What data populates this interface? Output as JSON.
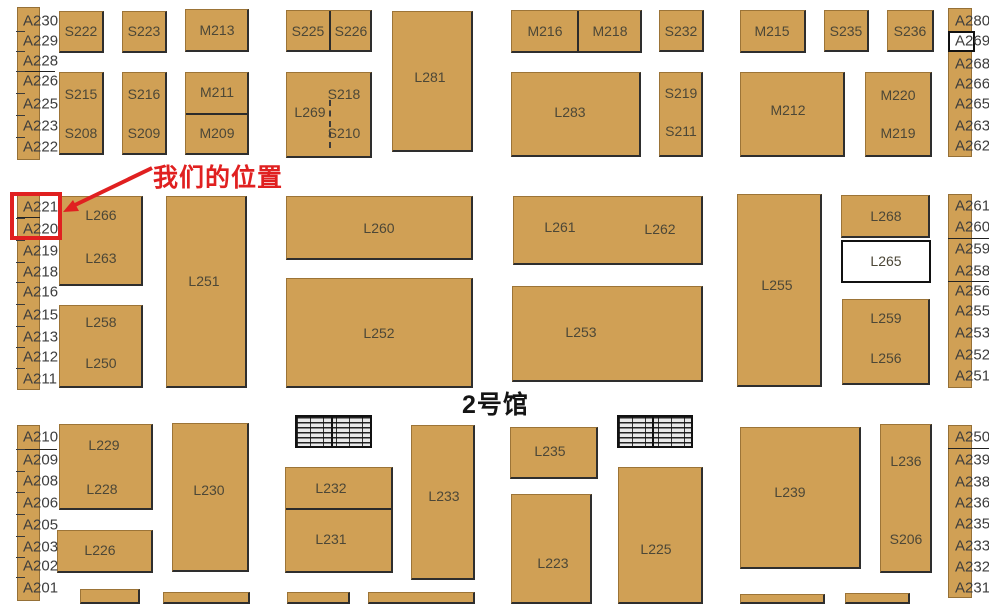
{
  "hall": {
    "title": "2号馆"
  },
  "annotation": {
    "label": "我们的位置",
    "color": "#e02020",
    "text_x": 153,
    "text_y": 158,
    "arrow": {
      "x1": 152,
      "y1": 168,
      "x2": 75,
      "y2": 205,
      "tip": [
        63,
        212
      ],
      "head": [
        [
          63,
          212
        ],
        [
          79,
          211
        ],
        [
          73,
          200
        ]
      ]
    },
    "highlight_box": {
      "x": 10,
      "y": 192,
      "w": 52,
      "h": 48,
      "booths": [
        "A221",
        "A220"
      ]
    }
  },
  "colors": {
    "booth_fill": "#d0a055",
    "booth_text": "#4c4737",
    "strip_text": "#3d3d3d",
    "white_fill": "#ffffff",
    "accent_red": "#e02020"
  },
  "booths": [
    {
      "id": "S222",
      "x": 59,
      "y": 11,
      "w": 45,
      "h": 42,
      "labels": [
        {
          "t": "S222",
          "x": 81,
          "y": 31
        }
      ]
    },
    {
      "id": "S223",
      "x": 122,
      "y": 11,
      "w": 45,
      "h": 42,
      "labels": [
        {
          "t": "S223",
          "x": 144,
          "y": 31
        }
      ]
    },
    {
      "id": "M213",
      "x": 185,
      "y": 9,
      "w": 64,
      "h": 43,
      "labels": [
        {
          "t": "M213",
          "x": 217,
          "y": 30
        }
      ]
    },
    {
      "id": "S225-S226",
      "x": 286,
      "y": 10,
      "w": 86,
      "h": 42,
      "dividers": [
        {
          "o": "v",
          "at": 329
        }
      ],
      "labels": [
        {
          "t": "S225",
          "x": 308,
          "y": 31
        },
        {
          "t": "S226",
          "x": 351,
          "y": 31
        }
      ]
    },
    {
      "id": "L281",
      "x": 392,
      "y": 11,
      "w": 81,
      "h": 141,
      "labels": [
        {
          "t": "L281",
          "x": 430,
          "y": 77
        }
      ]
    },
    {
      "id": "M216-M218",
      "x": 511,
      "y": 10,
      "w": 131,
      "h": 43,
      "dividers": [
        {
          "o": "v",
          "at": 577
        }
      ],
      "labels": [
        {
          "t": "M216",
          "x": 545,
          "y": 31
        },
        {
          "t": "M218",
          "x": 610,
          "y": 31
        }
      ]
    },
    {
      "id": "S232",
      "x": 659,
      "y": 10,
      "w": 45,
      "h": 42,
      "labels": [
        {
          "t": "S232",
          "x": 681,
          "y": 31
        }
      ]
    },
    {
      "id": "M215",
      "x": 740,
      "y": 10,
      "w": 66,
      "h": 43,
      "labels": [
        {
          "t": "M215",
          "x": 772,
          "y": 31
        }
      ]
    },
    {
      "id": "S235",
      "x": 824,
      "y": 10,
      "w": 45,
      "h": 42,
      "labels": [
        {
          "t": "S235",
          "x": 846,
          "y": 31
        }
      ]
    },
    {
      "id": "S236",
      "x": 887,
      "y": 10,
      "w": 47,
      "h": 42,
      "labels": [
        {
          "t": "S236",
          "x": 910,
          "y": 31
        }
      ]
    },
    {
      "id": "S215-S208",
      "x": 59,
      "y": 72,
      "w": 45,
      "h": 83,
      "labels": [
        {
          "t": "S215",
          "x": 81,
          "y": 94
        },
        {
          "t": "S208",
          "x": 81,
          "y": 133
        }
      ]
    },
    {
      "id": "S216-S209",
      "x": 122,
      "y": 72,
      "w": 45,
      "h": 83,
      "labels": [
        {
          "t": "S216",
          "x": 144,
          "y": 94
        },
        {
          "t": "S209",
          "x": 144,
          "y": 133
        }
      ]
    },
    {
      "id": "M211-M209",
      "x": 185,
      "y": 72,
      "w": 64,
      "h": 83,
      "dividers": [
        {
          "o": "h",
          "at": 113
        }
      ],
      "labels": [
        {
          "t": "M211",
          "x": 217,
          "y": 92
        },
        {
          "t": "M209",
          "x": 217,
          "y": 133
        }
      ]
    },
    {
      "id": "S218-L269-S210",
      "x": 286,
      "y": 72,
      "w": 86,
      "h": 86,
      "dividers": [
        {
          "o": "vd",
          "at": 329,
          "from": 100,
          "to": 148
        }
      ],
      "labels": [
        {
          "t": "S218",
          "x": 344,
          "y": 94
        },
        {
          "t": "L269",
          "x": 310,
          "y": 112
        },
        {
          "t": "S210",
          "x": 344,
          "y": 133
        }
      ]
    },
    {
      "id": "L283",
      "x": 511,
      "y": 72,
      "w": 130,
      "h": 85,
      "labels": [
        {
          "t": "L283",
          "x": 570,
          "y": 112
        }
      ]
    },
    {
      "id": "S219-S211",
      "x": 659,
      "y": 72,
      "w": 44,
      "h": 85,
      "labels": [
        {
          "t": "S219",
          "x": 681,
          "y": 93
        },
        {
          "t": "S211",
          "x": 681,
          "y": 131
        }
      ]
    },
    {
      "id": "M212",
      "x": 740,
      "y": 72,
      "w": 105,
      "h": 85,
      "labels": [
        {
          "t": "M212",
          "x": 788,
          "y": 110
        }
      ]
    },
    {
      "id": "M220-M219",
      "x": 865,
      "y": 72,
      "w": 67,
      "h": 85,
      "labels": [
        {
          "t": "M220",
          "x": 898,
          "y": 95
        },
        {
          "t": "M219",
          "x": 898,
          "y": 133
        }
      ]
    },
    {
      "id": "L266-L263",
      "x": 59,
      "y": 196,
      "w": 84,
      "h": 90,
      "labels": [
        {
          "t": "L266",
          "x": 101,
          "y": 215
        },
        {
          "t": "L263",
          "x": 101,
          "y": 258
        }
      ]
    },
    {
      "id": "L251",
      "x": 166,
      "y": 196,
      "w": 81,
      "h": 192,
      "labels": [
        {
          "t": "L251",
          "x": 204,
          "y": 281
        }
      ]
    },
    {
      "id": "L258-L250",
      "x": 59,
      "y": 305,
      "w": 84,
      "h": 83,
      "labels": [
        {
          "t": "L258",
          "x": 101,
          "y": 322
        },
        {
          "t": "L250",
          "x": 101,
          "y": 363
        }
      ]
    },
    {
      "id": "L260",
      "x": 286,
      "y": 196,
      "w": 187,
      "h": 64,
      "labels": [
        {
          "t": "L260",
          "x": 379,
          "y": 228
        }
      ]
    },
    {
      "id": "L252",
      "x": 286,
      "y": 278,
      "w": 187,
      "h": 110,
      "labels": [
        {
          "t": "L252",
          "x": 379,
          "y": 333
        }
      ]
    },
    {
      "id": "L261-L262",
      "x": 513,
      "y": 196,
      "w": 190,
      "h": 69,
      "labels": [
        {
          "t": "L261",
          "x": 560,
          "y": 227
        },
        {
          "t": "L262",
          "x": 660,
          "y": 229
        }
      ]
    },
    {
      "id": "L253",
      "x": 512,
      "y": 286,
      "w": 191,
      "h": 96,
      "labels": [
        {
          "t": "L253",
          "x": 581,
          "y": 332
        }
      ]
    },
    {
      "id": "L255",
      "x": 737,
      "y": 194,
      "w": 85,
      "h": 193,
      "labels": [
        {
          "t": "L255",
          "x": 777,
          "y": 285
        }
      ]
    },
    {
      "id": "L268",
      "x": 841,
      "y": 195,
      "w": 89,
      "h": 43,
      "labels": [
        {
          "t": "L268",
          "x": 886,
          "y": 216
        }
      ]
    },
    {
      "id": "L265",
      "x": 841,
      "y": 240,
      "w": 90,
      "h": 43,
      "fill": "white",
      "labels": [
        {
          "t": "L265",
          "x": 886,
          "y": 261
        }
      ]
    },
    {
      "id": "L259-L256",
      "x": 842,
      "y": 299,
      "w": 88,
      "h": 86,
      "labels": [
        {
          "t": "L259",
          "x": 886,
          "y": 318
        },
        {
          "t": "L256",
          "x": 886,
          "y": 358
        }
      ]
    },
    {
      "id": "A269-box",
      "x": 948,
      "y": 31,
      "w": 27,
      "h": 21,
      "fill": "white",
      "labels": []
    },
    {
      "id": "L229-L228",
      "x": 59,
      "y": 424,
      "w": 94,
      "h": 86,
      "labels": [
        {
          "t": "L229",
          "x": 104,
          "y": 445
        },
        {
          "t": "L228",
          "x": 102,
          "y": 489
        }
      ]
    },
    {
      "id": "L226",
      "x": 57,
      "y": 530,
      "w": 96,
      "h": 43,
      "labels": [
        {
          "t": "L226",
          "x": 100,
          "y": 550
        }
      ]
    },
    {
      "id": "L230",
      "x": 172,
      "y": 423,
      "w": 77,
      "h": 149,
      "labels": [
        {
          "t": "L230",
          "x": 209,
          "y": 490
        }
      ]
    },
    {
      "id": "L232-L231",
      "x": 285,
      "y": 467,
      "w": 108,
      "h": 106,
      "dividers": [
        {
          "o": "h",
          "at": 508
        }
      ],
      "labels": [
        {
          "t": "L232",
          "x": 331,
          "y": 488
        },
        {
          "t": "L231",
          "x": 331,
          "y": 539
        }
      ]
    },
    {
      "id": "L233",
      "x": 411,
      "y": 425,
      "w": 64,
      "h": 155,
      "labels": [
        {
          "t": "L233",
          "x": 444,
          "y": 496
        }
      ]
    },
    {
      "id": "L235",
      "x": 510,
      "y": 427,
      "w": 88,
      "h": 52,
      "labels": [
        {
          "t": "L235",
          "x": 550,
          "y": 451
        }
      ]
    },
    {
      "id": "L223",
      "x": 511,
      "y": 494,
      "w": 81,
      "h": 110,
      "labels": [
        {
          "t": "L223",
          "x": 553,
          "y": 563
        }
      ]
    },
    {
      "id": "L225",
      "x": 618,
      "y": 467,
      "w": 85,
      "h": 137,
      "labels": [
        {
          "t": "L225",
          "x": 656,
          "y": 549
        }
      ]
    },
    {
      "id": "L239",
      "x": 740,
      "y": 427,
      "w": 121,
      "h": 142,
      "labels": [
        {
          "t": "L239",
          "x": 790,
          "y": 492
        }
      ]
    },
    {
      "id": "L236-S206",
      "x": 880,
      "y": 424,
      "w": 52,
      "h": 149,
      "labels": [
        {
          "t": "L236",
          "x": 906,
          "y": 461
        },
        {
          "t": "S206",
          "x": 906,
          "y": 539
        }
      ]
    },
    {
      "id": "edge-1",
      "x": 80,
      "y": 589,
      "w": 60,
      "h": 15,
      "labels": []
    },
    {
      "id": "edge-2",
      "x": 163,
      "y": 592,
      "w": 87,
      "h": 12,
      "labels": []
    },
    {
      "id": "edge-3",
      "x": 287,
      "y": 592,
      "w": 63,
      "h": 12,
      "labels": []
    },
    {
      "id": "edge-4",
      "x": 368,
      "y": 592,
      "w": 107,
      "h": 12,
      "labels": []
    },
    {
      "id": "edge-5",
      "x": 740,
      "y": 594,
      "w": 85,
      "h": 10,
      "labels": []
    },
    {
      "id": "edge-6",
      "x": 845,
      "y": 593,
      "w": 65,
      "h": 11,
      "labels": []
    }
  ],
  "strips": [
    {
      "id": "left-top",
      "x": 17,
      "y": 7,
      "w": 23,
      "h": 153,
      "labelX": 23,
      "ticks": true,
      "labels": [
        {
          "t": "A230",
          "y": 21
        },
        {
          "t": "A229",
          "y": 41
        },
        {
          "t": "A228",
          "y": 61
        },
        {
          "t": "A226",
          "y": 81
        },
        {
          "t": "A225",
          "y": 104
        },
        {
          "t": "A223",
          "y": 126
        },
        {
          "t": "A222",
          "y": 147
        }
      ],
      "lines": [
        {
          "y": 71,
          "x1": 17,
          "x2": 55
        }
      ]
    },
    {
      "id": "left-mid",
      "x": 17,
      "y": 192,
      "w": 23,
      "h": 198,
      "labelX": 23,
      "ticks": true,
      "labels": [
        {
          "t": "A221",
          "y": 207
        },
        {
          "t": "A220",
          "y": 229
        },
        {
          "t": "A219",
          "y": 251
        },
        {
          "t": "A218",
          "y": 272
        },
        {
          "t": "A216",
          "y": 292
        },
        {
          "t": "A215",
          "y": 315
        },
        {
          "t": "A213",
          "y": 337
        },
        {
          "t": "A212",
          "y": 357
        },
        {
          "t": "A211",
          "y": 379
        }
      ],
      "lines": [
        {
          "y": 217,
          "x1": 17,
          "x2": 40
        }
      ]
    },
    {
      "id": "left-bottom",
      "x": 17,
      "y": 425,
      "w": 23,
      "h": 176,
      "labelX": 23,
      "ticks": true,
      "labels": [
        {
          "t": "A210",
          "y": 437
        },
        {
          "t": "A209",
          "y": 460
        },
        {
          "t": "A208",
          "y": 481
        },
        {
          "t": "A206",
          "y": 503
        },
        {
          "t": "A205",
          "y": 525
        },
        {
          "t": "A203",
          "y": 547
        },
        {
          "t": "A202",
          "y": 566
        },
        {
          "t": "A201",
          "y": 588
        }
      ],
      "lines": [
        {
          "y": 449,
          "x1": 17,
          "x2": 57
        }
      ]
    },
    {
      "id": "right-top",
      "x": 948,
      "y": 8,
      "w": 24,
      "h": 149,
      "labelX": 955,
      "ticks": false,
      "labels": [
        {
          "t": "A280",
          "y": 21
        },
        {
          "t": "A269",
          "y": 41
        },
        {
          "t": "A268",
          "y": 64
        },
        {
          "t": "A266",
          "y": 84
        },
        {
          "t": "A265",
          "y": 104
        },
        {
          "t": "A263",
          "y": 126
        },
        {
          "t": "A262",
          "y": 146
        }
      ],
      "lines": []
    },
    {
      "id": "right-mid",
      "x": 948,
      "y": 194,
      "w": 24,
      "h": 194,
      "labelX": 955,
      "ticks": false,
      "labels": [
        {
          "t": "A261",
          "y": 206
        },
        {
          "t": "A260",
          "y": 227
        },
        {
          "t": "A259",
          "y": 249
        },
        {
          "t": "A258",
          "y": 271
        },
        {
          "t": "A256",
          "y": 291
        },
        {
          "t": "A255",
          "y": 311
        },
        {
          "t": "A253",
          "y": 333
        },
        {
          "t": "A252",
          "y": 355
        },
        {
          "t": "A251",
          "y": 376
        }
      ],
      "lines": [
        {
          "y": 238,
          "x1": 948,
          "x2": 989
        },
        {
          "y": 281,
          "x1": 948,
          "x2": 989
        }
      ]
    },
    {
      "id": "right-bottom",
      "x": 948,
      "y": 425,
      "w": 24,
      "h": 173,
      "labelX": 955,
      "ticks": false,
      "labels": [
        {
          "t": "A250",
          "y": 437
        },
        {
          "t": "A239",
          "y": 460
        },
        {
          "t": "A238",
          "y": 482
        },
        {
          "t": "A236",
          "y": 503
        },
        {
          "t": "A235",
          "y": 524
        },
        {
          "t": "A233",
          "y": 546
        },
        {
          "t": "A232",
          "y": 567
        },
        {
          "t": "A231",
          "y": 588
        }
      ],
      "lines": [
        {
          "y": 448,
          "x1": 948,
          "x2": 989
        }
      ]
    }
  ],
  "stairs": [
    {
      "id": "escalator-1",
      "x": 295,
      "y": 415,
      "w": 77,
      "h": 33
    },
    {
      "id": "escalator-2",
      "x": 617,
      "y": 415,
      "w": 76,
      "h": 33
    }
  ],
  "hall_title_pos": {
    "x": 462,
    "y": 385
  }
}
